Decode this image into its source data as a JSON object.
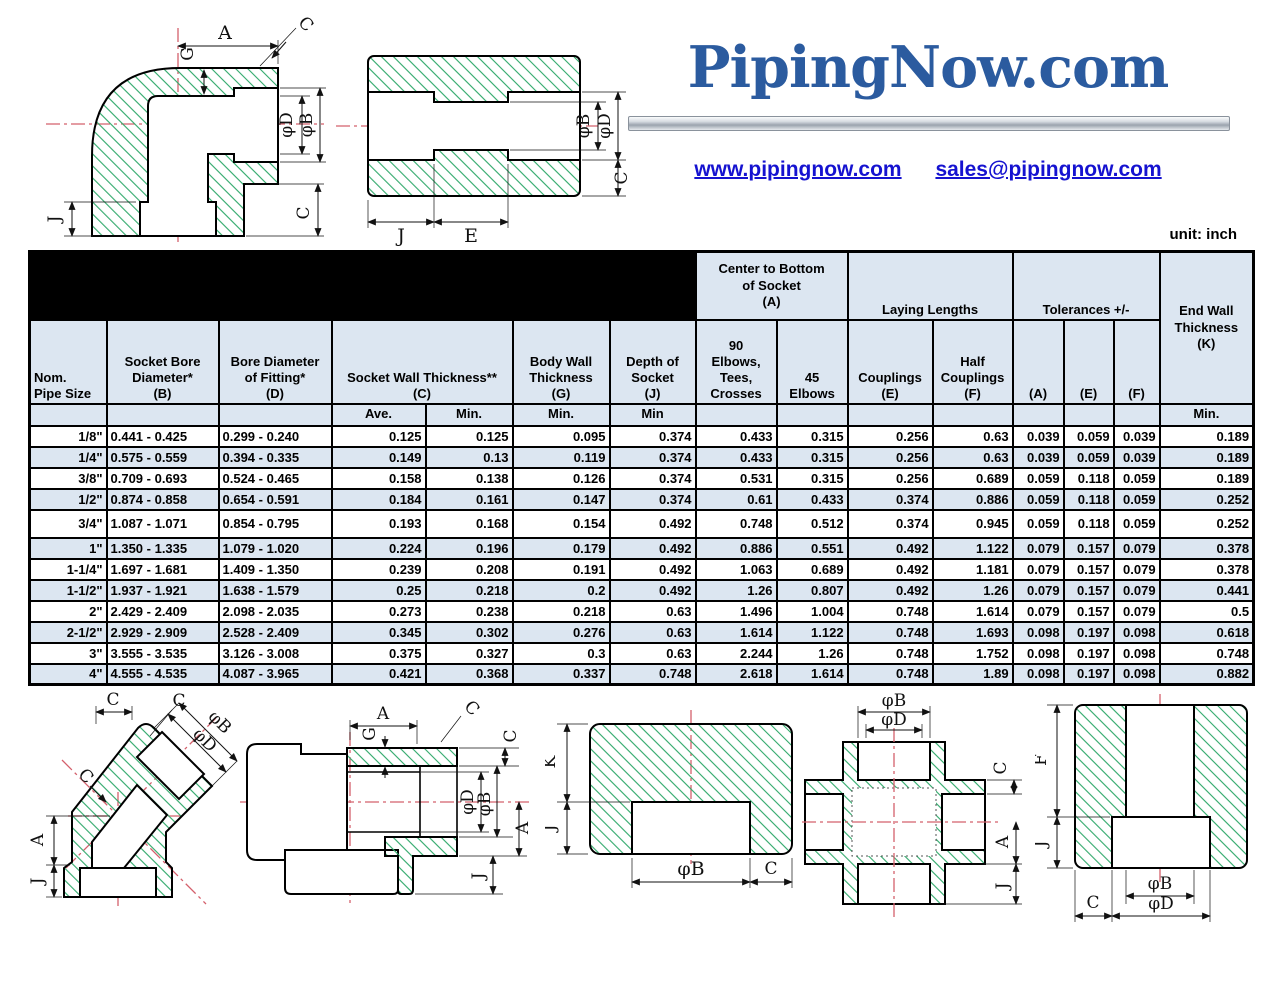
{
  "page": {
    "unit_label": "unit: inch"
  },
  "brand": {
    "logo_text": "PipingNow.com",
    "website": "www.pipingnow.com",
    "email": "sales@pipingnow.com"
  },
  "colors": {
    "logo_blue": "#2b5b9f",
    "link_blue": "#1512d0",
    "header_fill": "#dce6f1",
    "hatch_green": "#2fa86a",
    "centerline_red": "#d4606c"
  },
  "table": {
    "title_line1": "3000# SOCKET WELD FITTING DIMENSIONS",
    "title_line2": "STAINLESS STEEL 304/304L, 316/316L  A182",
    "groups": {
      "center_bottom": [
        "Center to Bottom",
        "of Socket",
        "(A)"
      ],
      "laying": "Laying Lengths",
      "tolerances": "Tolerances +/-"
    },
    "headers": {
      "size": [
        "Nom.",
        "Pipe Size"
      ],
      "b": [
        "Socket Bore",
        "Diameter*",
        "(B)"
      ],
      "d": [
        "Bore Diameter",
        "of Fitting*",
        "(D)"
      ],
      "c": [
        "Socket Wall Thickness**",
        "(C)"
      ],
      "g": [
        "Body Wall",
        "Thickness",
        "(G)"
      ],
      "j": [
        "Depth of",
        "Socket",
        "(J)"
      ],
      "a90": [
        "90",
        "Elbows,",
        "Tees,",
        "Crosses"
      ],
      "a45": "45 Elbows",
      "e": [
        "Couplings",
        "(E)"
      ],
      "f": [
        "Half",
        "Couplings",
        "(F)"
      ],
      "tol_a": "(A)",
      "tol_e": "(E)",
      "tol_f": "(F)",
      "k": [
        "End Wall",
        "Thickness",
        "(K)"
      ]
    },
    "subheader": {
      "c_ave": "Ave.",
      "c_min": "Min.",
      "g": "Min.",
      "j": "Min",
      "k": "Min."
    },
    "rows": [
      [
        "1/8\"",
        "0.441 - 0.425",
        "0.299 - 0.240",
        "0.125",
        "0.125",
        "0.095",
        "0.374",
        "0.433",
        "0.315",
        "0.256",
        "0.63",
        "0.039",
        "0.059",
        "0.039",
        "0.189"
      ],
      [
        "1/4\"",
        "0.575 - 0.559",
        "0.394 - 0.335",
        "0.149",
        "0.13",
        "0.119",
        "0.374",
        "0.433",
        "0.315",
        "0.256",
        "0.63",
        "0.039",
        "0.059",
        "0.039",
        "0.189"
      ],
      [
        "3/8\"",
        "0.709 - 0.693",
        "0.524 - 0.465",
        "0.158",
        "0.138",
        "0.126",
        "0.374",
        "0.531",
        "0.315",
        "0.256",
        "0.689",
        "0.059",
        "0.118",
        "0.059",
        "0.189"
      ],
      [
        "1/2\"",
        "0.874 - 0.858",
        "0.654 - 0.591",
        "0.184",
        "0.161",
        "0.147",
        "0.374",
        "0.61",
        "0.433",
        "0.374",
        "0.886",
        "0.059",
        "0.118",
        "0.059",
        "0.252"
      ],
      [
        "3/4\"",
        "1.087 - 1.071",
        "0.854 - 0.795",
        "0.193",
        "0.168",
        "0.154",
        "0.492",
        "0.748",
        "0.512",
        "0.374",
        "0.945",
        "0.059",
        "0.118",
        "0.059",
        "0.252"
      ],
      [
        "1\"",
        "1.350 - 1.335",
        "1.079 - 1.020",
        "0.224",
        "0.196",
        "0.179",
        "0.492",
        "0.886",
        "0.551",
        "0.492",
        "1.122",
        "0.079",
        "0.157",
        "0.079",
        "0.378"
      ],
      [
        "1-1/4\"",
        "1.697 - 1.681",
        "1.409 - 1.350",
        "0.239",
        "0.208",
        "0.191",
        "0.492",
        "1.063",
        "0.689",
        "0.492",
        "1.181",
        "0.079",
        "0.157",
        "0.079",
        "0.378"
      ],
      [
        "1-1/2\"",
        "1.937 - 1.921",
        "1.638 - 1.579",
        "0.25",
        "0.218",
        "0.2",
        "0.492",
        "1.26",
        "0.807",
        "0.492",
        "1.26",
        "0.079",
        "0.157",
        "0.079",
        "0.441"
      ],
      [
        "2\"",
        "2.429 - 2.409",
        "2.098 - 2.035",
        "0.273",
        "0.238",
        "0.218",
        "0.63",
        "1.496",
        "1.004",
        "0.748",
        "1.614",
        "0.079",
        "0.157",
        "0.079",
        "0.5"
      ],
      [
        "2-1/2\"",
        "2.929 - 2.909",
        "2.528 - 2.409",
        "0.345",
        "0.302",
        "0.276",
        "0.63",
        "1.614",
        "1.122",
        "0.748",
        "1.693",
        "0.098",
        "0.197",
        "0.098",
        "0.618"
      ],
      [
        "3\"",
        "3.555 - 3.535",
        "3.126 - 3.008",
        "0.375",
        "0.327",
        "0.3",
        "0.63",
        "2.244",
        "1.26",
        "0.748",
        "1.752",
        "0.098",
        "0.197",
        "0.098",
        "0.748"
      ],
      [
        "4\"",
        "4.555 - 4.535",
        "4.087 - 3.965",
        "0.421",
        "0.368",
        "0.337",
        "0.748",
        "2.618",
        "1.614",
        "0.748",
        "1.89",
        "0.098",
        "0.197",
        "0.098",
        "0.882"
      ]
    ]
  },
  "drawings": {
    "elbow90": {
      "labels": {
        "a": "A",
        "c_top": "C",
        "g": "G",
        "phi_d": "φD",
        "phi_b": "φB",
        "j": "J",
        "c_bottom": "C"
      }
    },
    "coupling": {
      "labels": {
        "phi_b": "φB",
        "phi_d": "φD",
        "c": "C",
        "j": "J",
        "e": "E"
      }
    },
    "elbow45": {
      "labels": {
        "c_top": "C",
        "c_face": "C",
        "phi_b": "φB",
        "phi_d": "φD",
        "c_left": "C",
        "a": "A",
        "j": "J"
      }
    },
    "tee": {
      "labels": {
        "a": "A",
        "g": "G",
        "c_diag": "C",
        "c_right": "C",
        "phi_d": "φD",
        "phi_b": "φB",
        "a_right": "A",
        "j": "J"
      }
    },
    "cap": {
      "labels": {
        "k": "K",
        "j": "J",
        "phi_b": "φB",
        "c": "C"
      }
    },
    "cross": {
      "labels": {
        "phi_b": "φB",
        "phi_d": "φD",
        "c": "C",
        "a": "A",
        "j": "J"
      }
    },
    "half_coupling": {
      "labels": {
        "f": "F",
        "j": "J",
        "c": "C",
        "phi_b": "φB",
        "phi_d": "φD"
      }
    }
  }
}
